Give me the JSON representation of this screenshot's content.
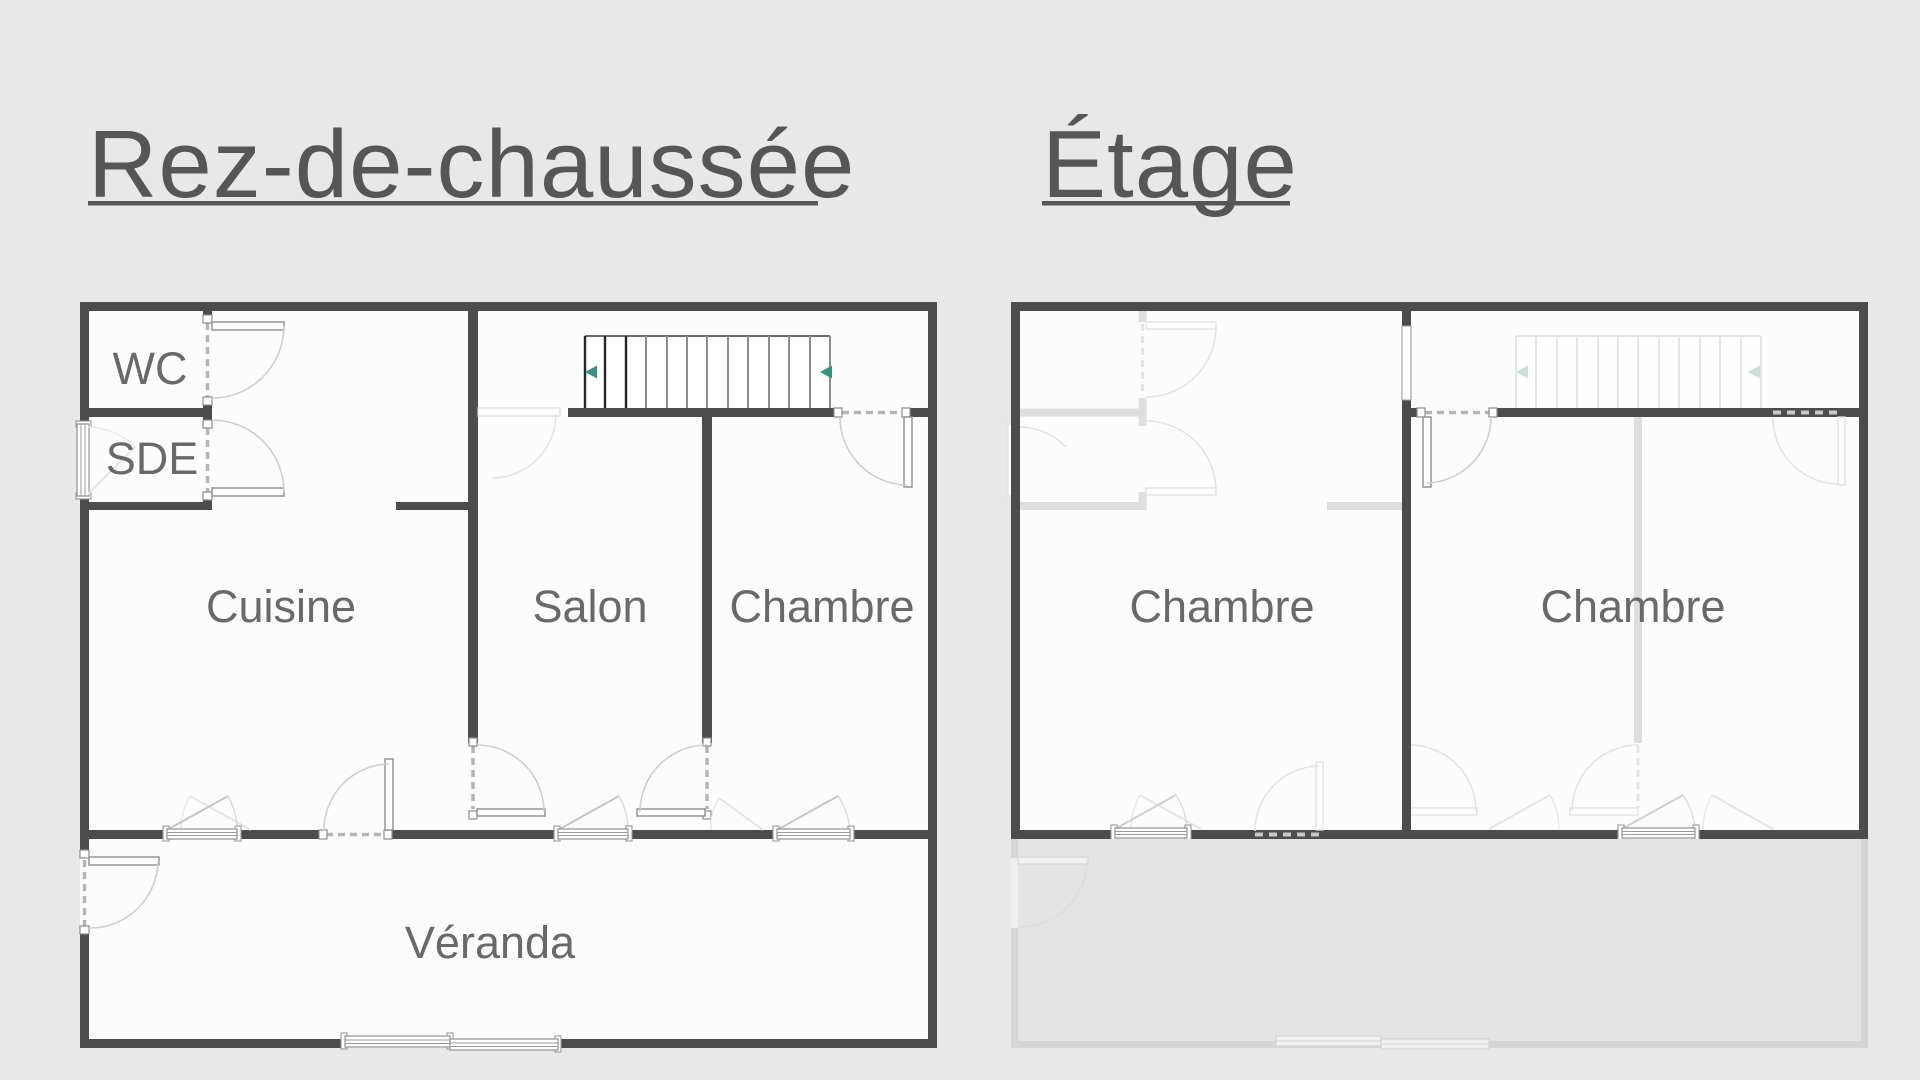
{
  "page": {
    "background_color": "#e8e8e8",
    "type": "architectural floor plan drawing"
  },
  "floors": [
    {
      "title": "Rez-de-chaussée",
      "rooms": [
        {
          "label": "WC"
        },
        {
          "label": "SDE"
        },
        {
          "label": "Cuisine"
        },
        {
          "label": "Salon"
        },
        {
          "label": "Chambre"
        },
        {
          "label": "Véranda"
        }
      ],
      "stairs": {
        "treads": 12,
        "direction_arrows": 2
      }
    },
    {
      "title": "Étage",
      "rooms": [
        {
          "label": "Chambre"
        },
        {
          "label": "Chambre"
        }
      ],
      "stairs": {
        "treads": 12,
        "direction_arrows": 2,
        "ghosted": true
      }
    }
  ],
  "colors": {
    "wall": "#4c4c4c",
    "title_text": "#565656",
    "room_label": "#696969",
    "stair_arrow_teal": "#3a9183",
    "ghost_lines": "#dedede",
    "door_arc": "#cfcfcf"
  }
}
